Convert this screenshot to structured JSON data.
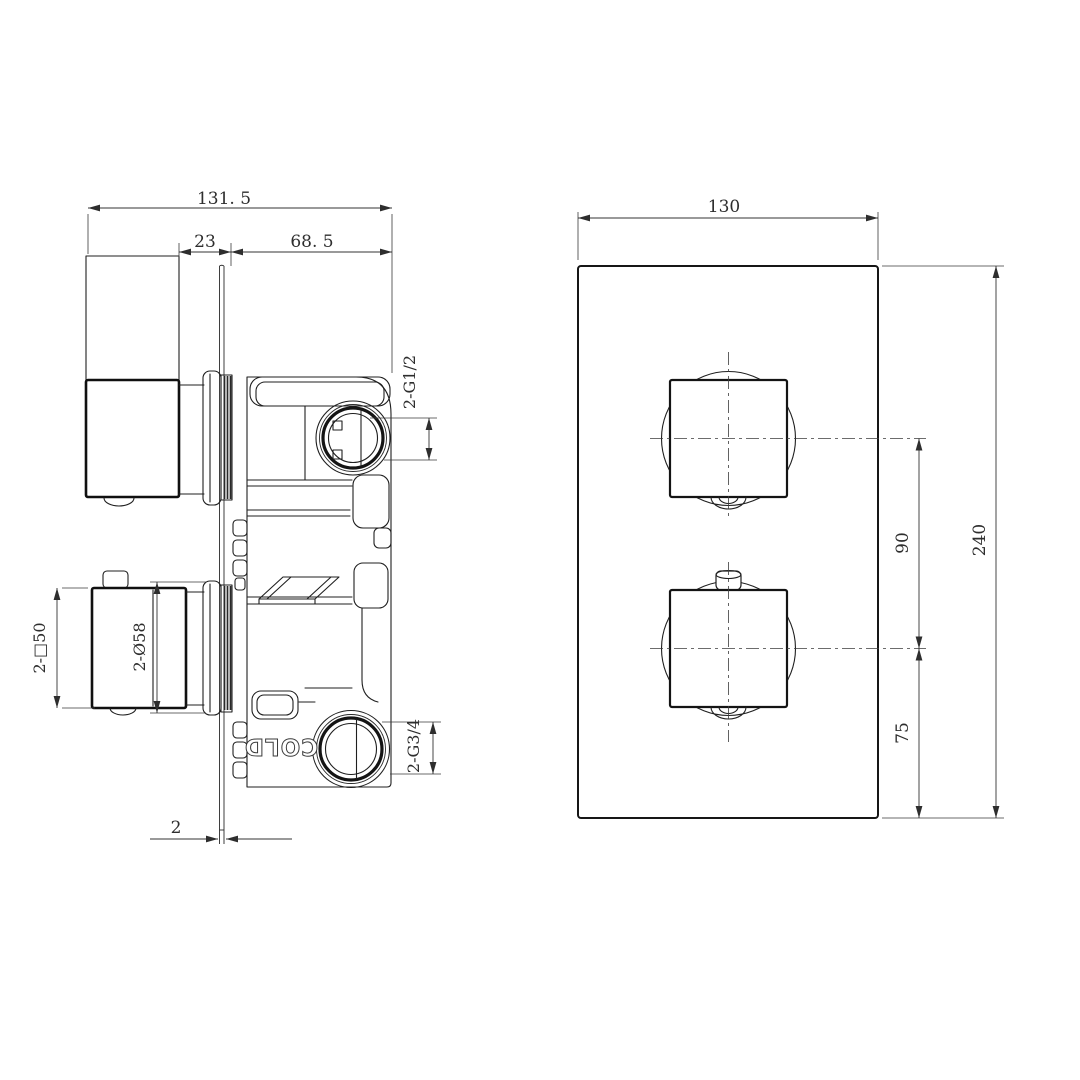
{
  "canvas": {
    "background": "#ffffff",
    "line_color": "#1f1f1f",
    "dim_color": "#2e2e2e"
  },
  "side_view": {
    "title": "side-section-view-of-concealed-shower-valve",
    "dim_overall_depth": "131. 5",
    "dim_handle_gap": "23",
    "dim_body_depth": "68. 5",
    "dim_plate_thickness": "2",
    "dim_handle_square": "2-□50",
    "dim_escutcheon_diameter": "2-Ø58",
    "dim_top_port_thread": "2-G1/2",
    "dim_bottom_port_thread": "2-G3/4",
    "engraving_cold": "COLD"
  },
  "front_view": {
    "title": "front-view-of-trim-plate",
    "dim_plate_width": "130",
    "dim_plate_height": "240",
    "dim_handle_spacing": "90",
    "dim_bottom_offset": "75"
  }
}
